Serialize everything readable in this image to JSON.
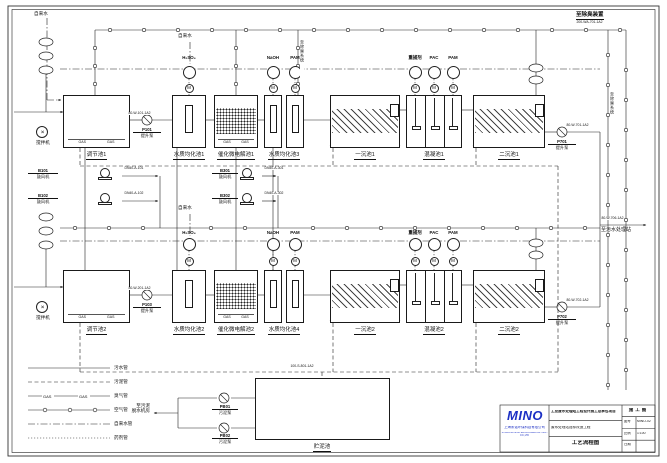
{
  "colors": {
    "ink": "#1a1a1a",
    "logo_blue": "#1b2fc4"
  },
  "top_right": {
    "dest": "至除臭装置",
    "code": "200-WA-701-1A2"
  },
  "outfall": {
    "code": "80-W-706-1A2",
    "label": "至污水处理站"
  },
  "exhaust_label": "至除臭系统",
  "water_supply": {
    "t1": "自来水",
    "t2": "自来水",
    "t3": "自来水"
  },
  "gas_mark": "GAS",
  "motor_mark": "M",
  "mixer_label": "搅拌机",
  "trains": [
    {
      "regulation": "调节池1",
      "lift_pump_tag": "P101",
      "lift_pump_name": "提升泵",
      "eq_a": "水质均化池1",
      "electrolysis": "催化微电解池1",
      "eq_b": "水质均化池3",
      "primary": "一沉池1",
      "coagulation": "混凝池1",
      "secondary": "二沉池1",
      "out_pump_tag": "P701",
      "out_pump_name": "提升泵",
      "code_out": "80-W-101-1A2",
      "code_final": "80-W-701-1A2",
      "dosing_acid": "H₂SO₄",
      "dosing_naoh": "NaOH",
      "dosing_pam_a": "PAM",
      "dosing_catcher": "重捕剂",
      "dosing_pac": "PAC",
      "dosing_pam_b": "PAM"
    },
    {
      "regulation": "调节池2",
      "lift_pump_tag": "P103",
      "lift_pump_name": "提升泵",
      "eq_a": "水质均化池2",
      "electrolysis": "催化微电解池2",
      "eq_b": "水质均化池4",
      "primary": "一沉池2",
      "coagulation": "混凝池2",
      "secondary": "二沉池2",
      "out_pump_tag": "P702",
      "out_pump_name": "提升泵",
      "code_out": "80-W-201-1A2",
      "code_final": "80-W-702-1A2",
      "dosing_acid": "H₂SO₄",
      "dosing_naoh": "NaOH",
      "dosing_pam_a": "PAM",
      "dosing_catcher": "重捕剂",
      "dosing_pac": "PAC",
      "dosing_pam_b": "PAM"
    }
  ],
  "blowers": [
    {
      "tag": "B101",
      "name": "鼓风机"
    },
    {
      "tag": "B102",
      "name": "鼓风机"
    },
    {
      "tag": "B301",
      "name": "鼓风机"
    },
    {
      "tag": "B302",
      "name": "鼓风机"
    }
  ],
  "blower_codes": [
    "DN40-A-101",
    "DN40-A-102",
    "DN40-A-301",
    "DN40-A-302"
  ],
  "sludge": {
    "tank": "贮泥池",
    "code": "100-S-801-1A2",
    "pump1_tag": "PB01",
    "pump1_name": "污泥泵",
    "pump2_tag": "PB02",
    "pump2_name": "污泥泵",
    "dewater_1": "至污泥",
    "dewater_2": "脱水机房"
  },
  "legend": {
    "rows": [
      {
        "label": "污水管"
      },
      {
        "label": "污泥管"
      },
      {
        "label": "臭气管"
      },
      {
        "label": "空气管"
      },
      {
        "label": "自来水管"
      },
      {
        "label": "药剂管"
      }
    ]
  },
  "titleblock": {
    "logo": "MINO",
    "company_cn": "上海米诺环保科技有限公司",
    "company_en": "SHANGHAI MINO ENVIRONMENTAL TECH CO.,LTD",
    "project": "工业废水处理站工程设计施工总承包项目",
    "subproject": "废水处理站提标改造工程",
    "drawing": "工艺流程图",
    "stage": "施工图",
    "no_label": "图号",
    "no_value": "MINO-02",
    "scale_label": "比例",
    "scale_value": "1:100",
    "date_label": "日期",
    "date_value": ""
  }
}
